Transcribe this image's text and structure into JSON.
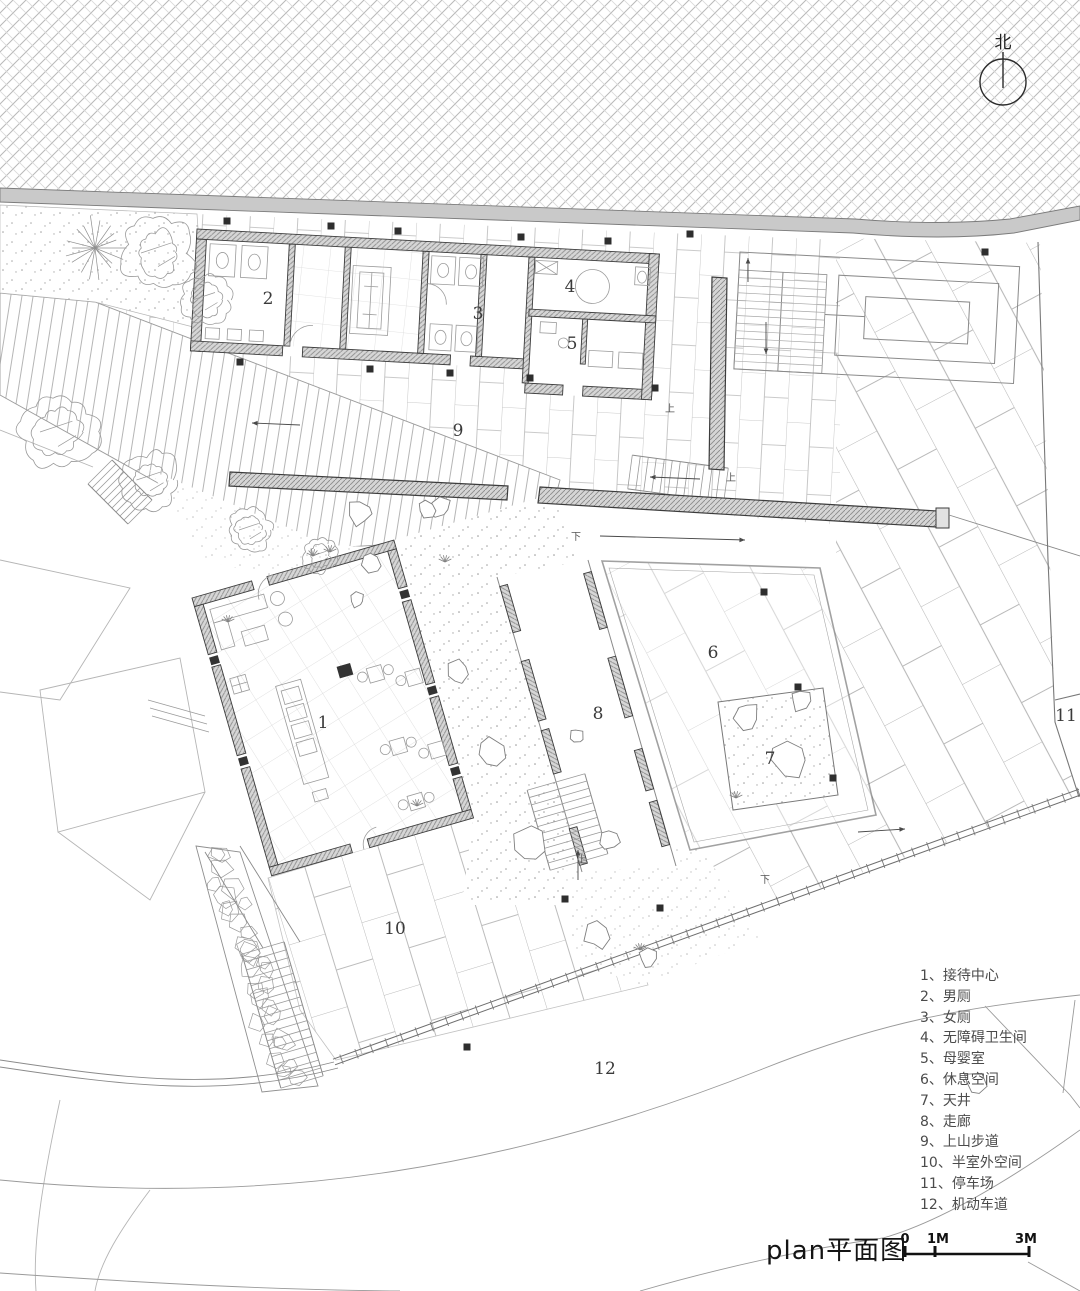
{
  "drawing": {
    "title": "plan平面图",
    "north_label": "北",
    "separator": "、",
    "scale_bar": {
      "labels": [
        "0",
        "1M",
        "3M"
      ]
    },
    "legend": [
      {
        "num": "1",
        "label": "接待中心"
      },
      {
        "num": "2",
        "label": "男厕"
      },
      {
        "num": "3",
        "label": "女厕"
      },
      {
        "num": "4",
        "label": "无障碍卫生间"
      },
      {
        "num": "5",
        "label": "母婴室"
      },
      {
        "num": "6",
        "label": "休息空间"
      },
      {
        "num": "7",
        "label": "天井"
      },
      {
        "num": "8",
        "label": "走廊"
      },
      {
        "num": "9",
        "label": "上山步道"
      },
      {
        "num": "10",
        "label": "半室外空间"
      },
      {
        "num": "11",
        "label": "停车场"
      },
      {
        "num": "12",
        "label": "机动车道"
      }
    ],
    "plan_labels": [
      {
        "num": "1",
        "x": 323,
        "y": 728
      },
      {
        "num": "2",
        "x": 268,
        "y": 304
      },
      {
        "num": "3",
        "x": 478,
        "y": 319
      },
      {
        "num": "4",
        "x": 570,
        "y": 292
      },
      {
        "num": "5",
        "x": 572,
        "y": 349
      },
      {
        "num": "6",
        "x": 713,
        "y": 658
      },
      {
        "num": "7",
        "x": 770,
        "y": 764
      },
      {
        "num": "8",
        "x": 598,
        "y": 719
      },
      {
        "num": "9",
        "x": 458,
        "y": 436
      },
      {
        "num": "10",
        "x": 395,
        "y": 934
      },
      {
        "num": "11",
        "x": 1066,
        "y": 721
      },
      {
        "num": "12",
        "x": 605,
        "y": 1074
      }
    ],
    "stair_marks": [
      {
        "text": "上",
        "x": 670,
        "y": 412
      },
      {
        "text": "上",
        "x": 731,
        "y": 481
      },
      {
        "text": "下",
        "x": 576,
        "y": 540
      },
      {
        "text": "上",
        "x": 582,
        "y": 863
      },
      {
        "text": "下",
        "x": 765,
        "y": 883
      }
    ],
    "colors": {
      "line": "#7a7a7a",
      "dark_line": "#3c3c3c",
      "wall_fill": "#cfcfcf",
      "road_fill": "#c9c9c9",
      "tile_line": "#b6b6b6",
      "column": "#2e2e2e",
      "paper": "#ffffff"
    }
  }
}
